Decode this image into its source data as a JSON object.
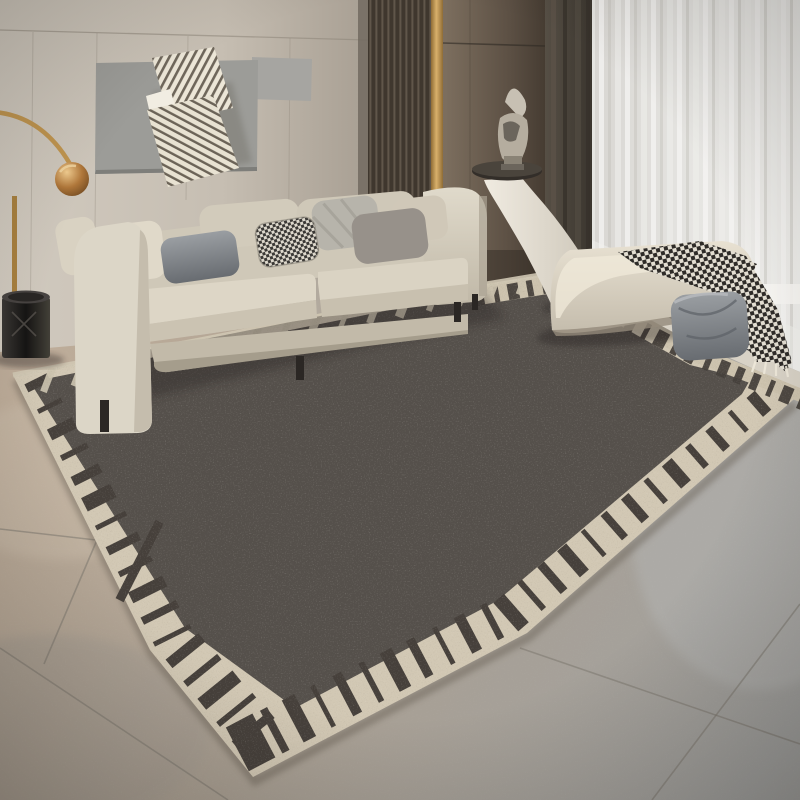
{
  "scene": {
    "description": "Modern living room: charcoal area rug with cream piano-key border, beige fabric sofa with assorted cushions, abstract striped wall sculpture on grey panel, wood slat wall with brass inlay, dark drape and white sheer curtain, arc floor lamp with copper globe, black bin, white sculptural side table with figurine, cream curved bench with grey cushion and houndstooth throw, large tiled floor"
  },
  "palette": {
    "wall": "#c9c2b7",
    "art_panel": "#9c9c98",
    "sculpture_cream": "#ece6d7",
    "sculpture_stripe": "#6f675b",
    "slat_dark": "#3f372e",
    "slat_light": "#5f554a",
    "gold": "#c9a05e",
    "wood_wall": "#6f6253",
    "curtain_dark": "#46413a",
    "sheer": "#e2e0dc",
    "sofa": "#d6cfc0",
    "pillow_dark": "#6b6a6e",
    "pillow_taupe": "#97918a",
    "pillow_silver": "#b7b4ab",
    "rug_field": "#55504b",
    "rug_border": "#d2c8b4",
    "rug_key": "#46403b",
    "floor_tan": "#b7a694",
    "floor_gray": "#a1a19f",
    "grout": "#7d786f",
    "bench": "#ddd6c7",
    "throw_dark": "#2e2b28",
    "throw_light": "#e3ded2",
    "bench_pillow": "#82868b",
    "lamp_gold": "#c0954f",
    "lamp_copper": "#b0773a",
    "bin": "#262321",
    "figurine": "#bcb5a8",
    "table_white": "#e9e4d9"
  },
  "objects": [
    {
      "name": "area-rug"
    },
    {
      "name": "sofa"
    },
    {
      "name": "wall-art"
    },
    {
      "name": "floor-lamp"
    },
    {
      "name": "waste-bin"
    },
    {
      "name": "side-table"
    },
    {
      "name": "figurine"
    },
    {
      "name": "bench"
    },
    {
      "name": "throw-blanket"
    },
    {
      "name": "sheer-curtain"
    },
    {
      "name": "dark-curtain"
    },
    {
      "name": "slat-wall"
    },
    {
      "name": "tile-floor"
    }
  ]
}
